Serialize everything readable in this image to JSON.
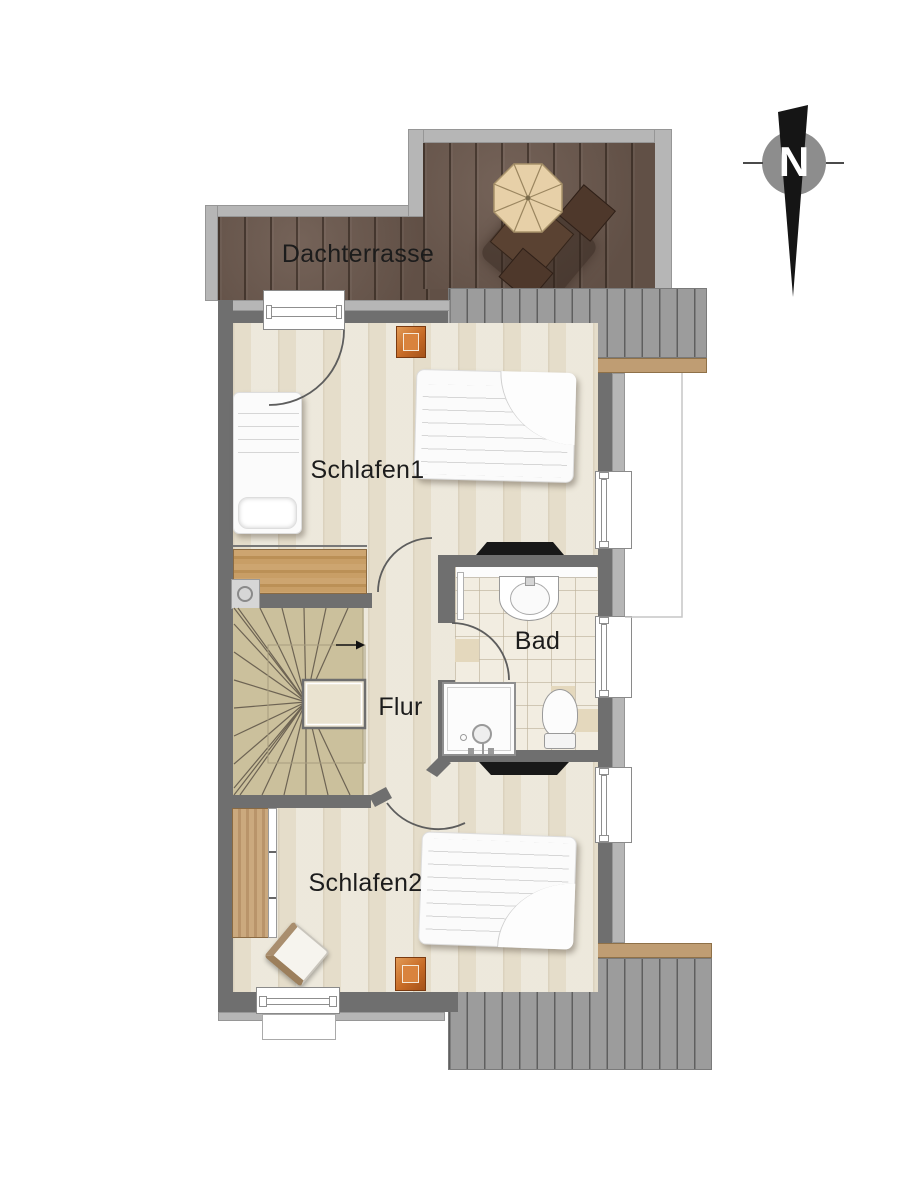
{
  "compass": {
    "north_label": "N"
  },
  "rooms": {
    "dachterrasse": {
      "label": "Dachterrasse"
    },
    "schlafen1": {
      "label": "Schlafen1"
    },
    "bad": {
      "label": "Bad"
    },
    "flur": {
      "label": "Flur"
    },
    "schlafen2": {
      "label": "Schlafen2"
    }
  },
  "colors": {
    "terrace_wood": "#6c594e",
    "balcony_gray": "#9c9c9c",
    "balcony_edge_tan": "#bf9d73",
    "wall_dark": "#6f6f6f",
    "wall_light": "#b6b6b6",
    "floor_beige": "#e9e3d3",
    "stair_beige": "#cbc09c",
    "tile_cream": "#f2ede1",
    "furniture_wood": "#c79e6b",
    "skylight_orange": "#cf7630",
    "parasol_tan": "#e7d0a8",
    "fixture_white": "#fcfcfc",
    "tv_black": "#181818"
  },
  "furniture": [
    "parasol",
    "terrace-table",
    "terrace-chairs",
    "double-bed-1",
    "single-bed",
    "sideboard",
    "lamp-table",
    "winder-staircase",
    "washbasin",
    "toilet",
    "shower",
    "wardrobe",
    "chair",
    "double-bed-2",
    "skylight-1",
    "skylight-2",
    "tv-board-1",
    "tv-board-2"
  ]
}
